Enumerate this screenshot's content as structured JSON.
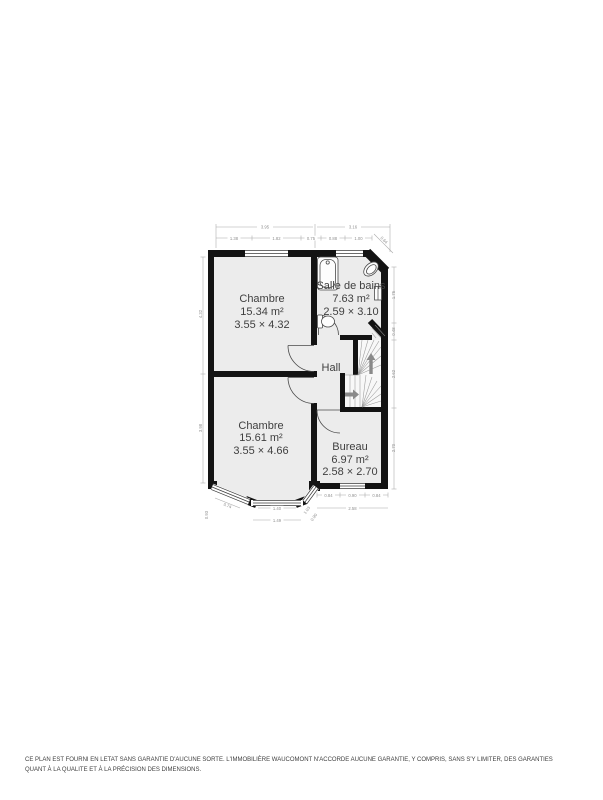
{
  "plan": {
    "rooms": {
      "chambre1": {
        "name": "Chambre",
        "area": "15.34 m²",
        "size": "3.55 × 4.32"
      },
      "salle_de_bains": {
        "name": "Salle de bains",
        "area": "7.63 m²",
        "size": "2.59 × 3.10"
      },
      "hall": {
        "name": "Hall"
      },
      "chambre2": {
        "name": "Chambre",
        "area": "15.61 m²",
        "size": "3.55 × 4.66"
      },
      "bureau": {
        "name": "Bureau",
        "area": "6.97 m²",
        "size": "2.58 × 2.70"
      }
    },
    "dimensions": {
      "top_overall_left": "3.95",
      "top_overall_right": "3.16",
      "top_seg_1": "1.38",
      "top_seg_2": "1.82",
      "top_seg_3": "0.75",
      "top_seg_4": "0.88",
      "top_seg_5": "1.00",
      "chamfer": "0.64",
      "right_1": "1.75",
      "right_2": "0.48",
      "right_3": "2.62",
      "right_4": "2.70",
      "left_1": "4.32",
      "left_2": "3.98",
      "bureau_seg_1": "0.84",
      "bureau_seg_2": "0.90",
      "bureau_seg_3": "0.84",
      "bureau_overall": "2.58",
      "bay_diag_left": "0.74",
      "bay_left": "0.93",
      "bay_window": "1.40",
      "bay_overall": "1.49",
      "bay_diag_right": "1.03",
      "bay_right": "0.90"
    }
  },
  "footer": {
    "disclaimer": "CE PLAN EST FOURNI EN LETAT SANS GARANTIE D'AUCUNE SORTE. L'IMMOBILIÈRE WAUCOMONT N'ACCORDE AUCUNE GARANTIE, Y COMPRIS, SANS S'Y LIMITER, DES GARANTIES QUANT À LA QUALITE ET À LA PRÉCISION DES DIMENSIONS."
  },
  "colors": {
    "wall": "#131313",
    "floor": "#ececec",
    "dim": "#8f8f8f",
    "label": "#3f3f3f"
  }
}
